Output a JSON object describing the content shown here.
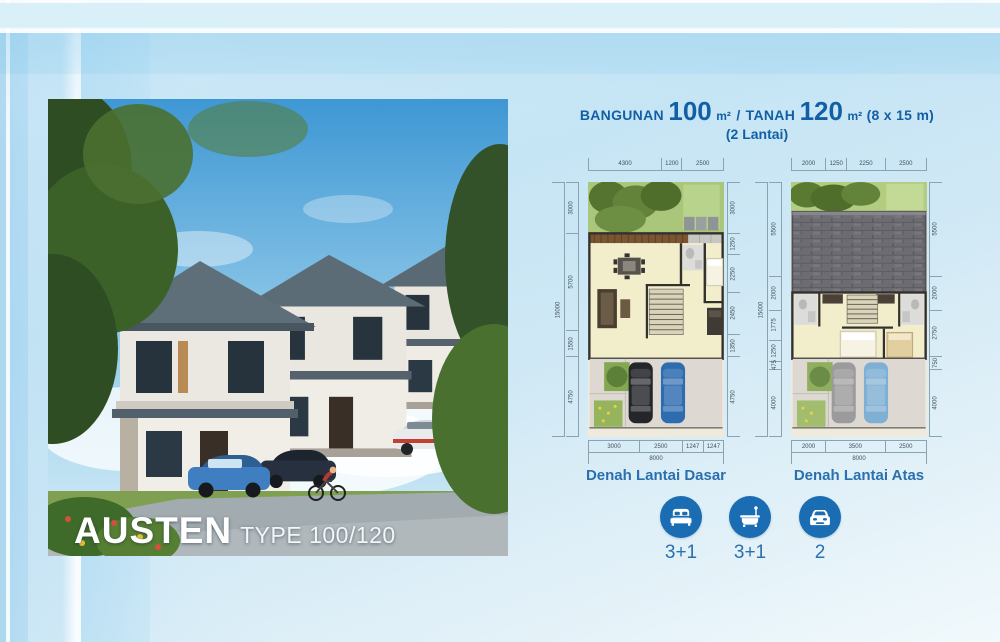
{
  "header": {
    "bangunan_label": "BANGUNAN",
    "bangunan_value": "100",
    "unit": "m²",
    "separator": "/",
    "tanah_label": "TANAH",
    "tanah_value": "120",
    "unit2": "m²",
    "lot_dims": "(8 x 15 m)",
    "floors": "(2 Lantai)"
  },
  "photo": {
    "project_name": "AUSTEN",
    "type_label": "TYPE 100/120"
  },
  "plans": [
    {
      "caption": "Denah Lantai Dasar",
      "dims_top": [
        "4300",
        "1200",
        "2500"
      ],
      "dims_bottom": [
        "3000",
        "2500",
        "1247",
        "1247"
      ],
      "dims_bottom_total": "8000",
      "dims_left": [
        "3000",
        "5700",
        "1550",
        "4750"
      ],
      "dims_left_total": "15000",
      "dims_right": [
        "3000",
        "1250",
        "2250",
        "2450",
        "1350",
        "4750"
      ]
    },
    {
      "caption": "Denah Lantai Atas",
      "dims_top": [
        "2000",
        "1250",
        "2250",
        "2500"
      ],
      "dims_bottom": [
        "2000",
        "3500",
        "2500"
      ],
      "dims_bottom_total": "8000",
      "dims_left": [
        "5500",
        "2000",
        "1775",
        "1250",
        "475",
        "4000"
      ],
      "dims_left_total": "15000",
      "dims_right": [
        "5500",
        "2000",
        "2750",
        "750",
        "4000"
      ]
    }
  ],
  "features": [
    {
      "icon": "bed-icon",
      "count": "3+1"
    },
    {
      "icon": "bath-icon",
      "count": "3+1"
    },
    {
      "icon": "car-icon",
      "count": "2"
    }
  ],
  "colors": {
    "accent_blue": "#135fa5",
    "icon_blue": "#1a6db3",
    "caption_blue": "#2b70ae",
    "background_blue": "#cfe9f6"
  }
}
